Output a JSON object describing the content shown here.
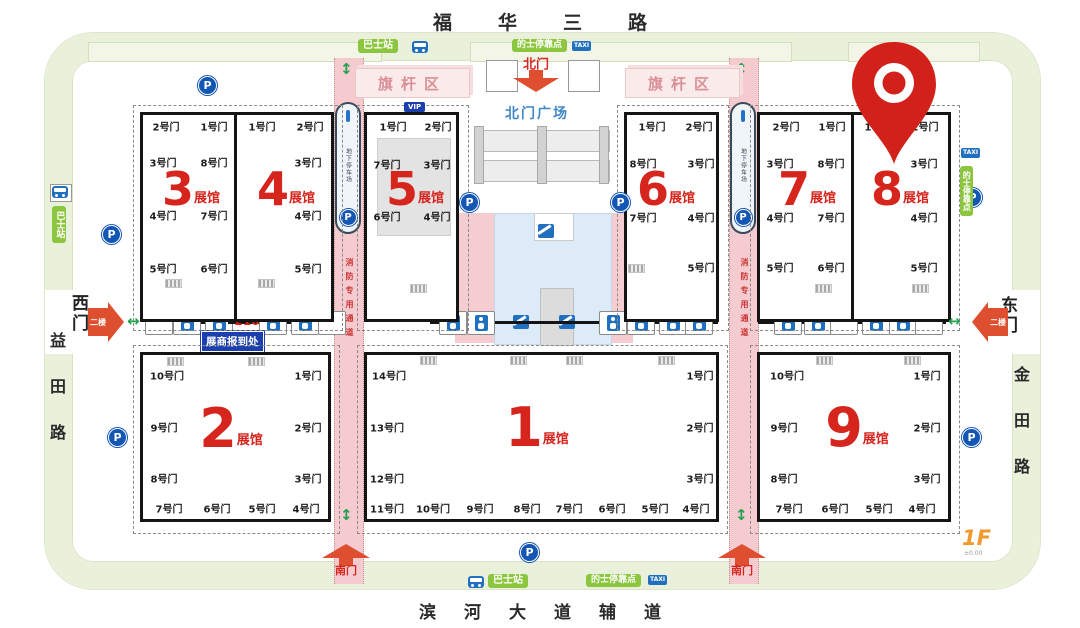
{
  "roads": {
    "north": "福华三路",
    "south": "滨河大道辅道",
    "west": "益田路",
    "east": "金田路"
  },
  "gates": {
    "north": "北门",
    "south": "南门",
    "west": "西门",
    "east": "东门",
    "floor_tag": "二楼"
  },
  "plaza": {
    "name": "北门广场",
    "flag_area": "旗杆区"
  },
  "transit": {
    "bus_stop": "巴士站",
    "taxi_stop": "的士停靠点",
    "taxi_sign": "TAXI"
  },
  "lanes": {
    "fire_lane": "消防专用通道",
    "parking_ramp": "地下停车场"
  },
  "registration": {
    "label": "展商报到处",
    "room": "216"
  },
  "icons": {
    "parking": "P",
    "vip": "VIP"
  },
  "floor": {
    "level": "1F",
    "elevation": "±0.00"
  },
  "colors": {
    "hall_red": "#d6251d",
    "pin_red": "#d2201a",
    "road_pink": "#f5cbd0",
    "ring_green": "#e9f1db",
    "label_green": "#8cc63e",
    "icon_blue": "#2170c0",
    "reg_blue": "#1c3fae"
  },
  "halls": {
    "suffix": "展馆",
    "h3": {
      "num": "3",
      "top": [
        "2号门",
        "1号门"
      ],
      "left": [
        "3号门",
        "4号门",
        "5号门"
      ],
      "right": [
        "8号门",
        "7号门",
        "6号门"
      ]
    },
    "h4": {
      "num": "4",
      "top": [
        "1号门",
        "2号门"
      ],
      "right": [
        "3号门",
        "4号门",
        "5号门"
      ]
    },
    "h5": {
      "num": "5",
      "top": [
        "1号门",
        "2号门"
      ],
      "left": [
        "7号门",
        "6号门"
      ],
      "right": [
        "3号门",
        "4号门"
      ]
    },
    "h6": {
      "num": "6",
      "top": [
        "1号门",
        "2号门"
      ],
      "left": [
        "8号门",
        "7号门"
      ],
      "right": [
        "3号门",
        "4号门",
        "5号门"
      ]
    },
    "h7": {
      "num": "7",
      "top": [
        "2号门",
        "1号门"
      ],
      "left": [
        "3号门",
        "4号门",
        "5号门"
      ],
      "right": [
        "8号门",
        "7号门",
        "6号门"
      ]
    },
    "h8": {
      "num": "8",
      "top": [
        "1号门",
        "2号门"
      ],
      "right": [
        "3号门",
        "4号门",
        "5号门"
      ]
    },
    "h2": {
      "num": "2",
      "left": [
        "10号门",
        "9号门",
        "8号门"
      ],
      "right": [
        "1号门",
        "2号门",
        "3号门"
      ],
      "bottom": [
        "7号门",
        "6号门",
        "5号门",
        "4号门"
      ]
    },
    "h1": {
      "num": "1",
      "left": [
        "14号门",
        "13号门",
        "12号门"
      ],
      "right": [
        "1号门",
        "2号门",
        "3号门"
      ],
      "bottom": [
        "11号门",
        "10号门",
        "9号门",
        "8号门",
        "7号门",
        "6号门",
        "5号门",
        "4号门"
      ]
    },
    "h9": {
      "num": "9",
      "left": [
        "10号门",
        "9号门",
        "8号门"
      ],
      "right": [
        "1号门",
        "2号门",
        "3号门"
      ],
      "bottom": [
        "7号门",
        "6号门",
        "5号门",
        "4号门"
      ]
    }
  }
}
